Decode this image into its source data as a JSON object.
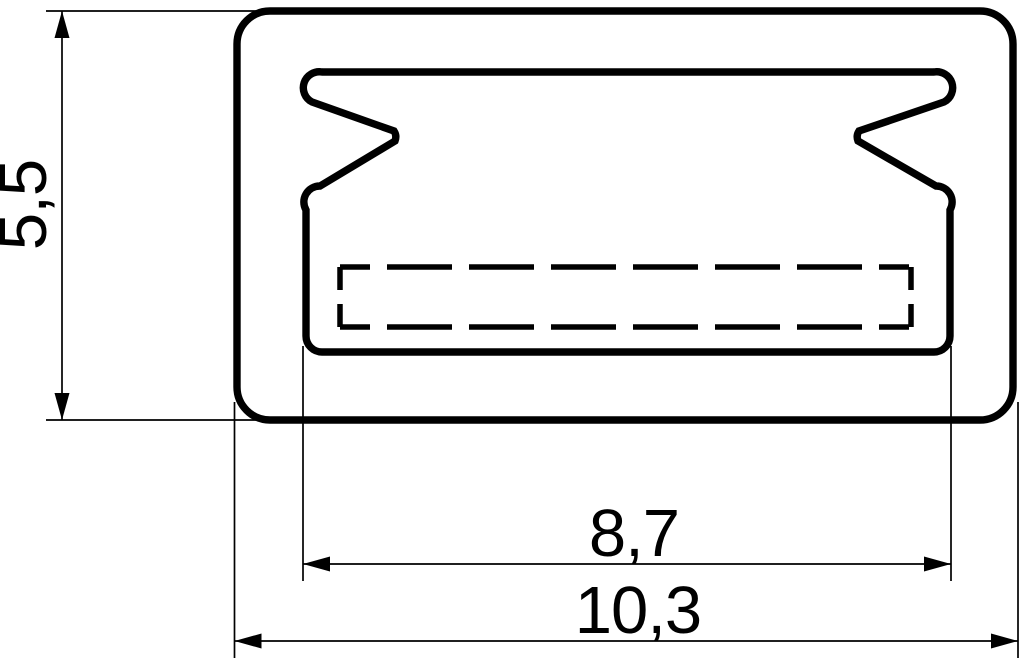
{
  "drawing": {
    "kind": "technical-cross-section-drawing",
    "colors": {
      "line": "#000000",
      "background": "#ffffff"
    },
    "dimensions": {
      "height": {
        "label": "5,5",
        "value": 5.5,
        "orientation": "vertical"
      },
      "inner_width": {
        "label": "8,7",
        "value": 8.7,
        "orientation": "horizontal"
      },
      "outer_width": {
        "label": "10,3",
        "value": 10.3,
        "orientation": "horizontal"
      }
    }
  }
}
